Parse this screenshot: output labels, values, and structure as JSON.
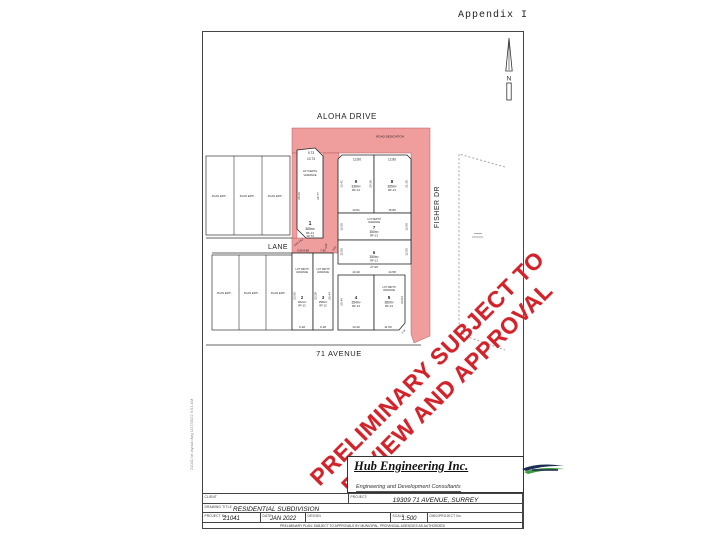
{
  "page": {
    "appendix_label": "Appendix I",
    "plot_stamp": "21041 lot layout.dwg   1/27/2022 9:51 AM"
  },
  "drawing": {
    "north_label": "N",
    "site_fill": "#ef9d9d",
    "streets": {
      "aloha": "ALOHA DRIVE",
      "lane": "LANE",
      "avenue71": "71 AVENUE",
      "fisher": "FISHER DR"
    },
    "road_dedication_note": "ROAD DEDICATION",
    "existing_lot_note": "PLAN EPP…",
    "misc_dims": {
      "d1": "5.32",
      "d2": "3.50"
    },
    "lots": {
      "lot1": {
        "number": "1",
        "area": "365m²",
        "zone": "RF-13",
        "note1": "LOT DEPTH",
        "note2": "VARIANCE",
        "dim_top1": "9.73",
        "dim_top2": "10.73",
        "dim_bottom": "10.73",
        "dim_left": "20.26",
        "dim_right": "26.77",
        "dim_corner": "0.62 4.62"
      },
      "lot2": {
        "number": "2",
        "area": "302m²",
        "zone": "RF-13",
        "note1": "LOT WIDTH",
        "note2": "VARIANCE",
        "dim_top": "0.50 8.68",
        "dim_left": "23.60",
        "dim_bottom": "9.18"
      },
      "lot3": {
        "number": "3",
        "area": "298m²",
        "zone": "RF-13",
        "note1": "LOT WIDTH",
        "note2": "VARIANCE",
        "dim_top": "7.56",
        "dim_left": "23.28",
        "dim_right": "26.44",
        "dim_bottom": "9.18"
      },
      "lot4": {
        "number": "4",
        "area": "354m²",
        "zone": "RF-13",
        "dim_top": "13.40",
        "dim_left": "26.44",
        "dim_bottom": "13.40"
      },
      "lot5": {
        "number": "5",
        "area": "380m²",
        "zone": "RF-13",
        "note1": "LOT WIDTH",
        "note2": "VARIANCE",
        "dim_top": "14.58",
        "dim_right": "23.04",
        "dim_bottom": "11.59",
        "dim_corner": "6.04"
      },
      "lot6": {
        "number": "6",
        "area": "350m²",
        "zone": "RF-13",
        "dim_left": "12.00",
        "dim_right": "12.05",
        "dim_bottom": "27.99"
      },
      "lot7": {
        "number": "7",
        "area": "350m²",
        "zone": "RF-13",
        "note1": "LOT DEPTH",
        "note2": "VARIANCE",
        "dim_left": "12.00",
        "dim_right": "12.00",
        "dim_bottom": "29.81"
      },
      "lot8": {
        "number": "8",
        "area": "365m²",
        "zone": "RF-13",
        "dim_top": "12.80",
        "dim_right": "21.35",
        "dim_bottom": "15.80"
      },
      "lot9": {
        "number": "9",
        "area": "336m²",
        "zone": "RF-13",
        "dim_top": "12.80",
        "dim_left": "13.41",
        "dim_right": "24.38",
        "dim_bottom": "13.81"
      }
    }
  },
  "stamp": {
    "line1": "PRELIMINARY SUBJECT TO",
    "line2": "REVIEW AND APPROVAL",
    "color": "#d2232a"
  },
  "titleblock": {
    "company_name": "Hub Engineering Inc.",
    "company_tagline": "Engineering and Development Consultants",
    "company_address": "Suite 312, 13955 - 76 Avenue, Surrey, B.C. V3W 2V6",
    "company_contact": "tel: 604-572-6528  |  fax: 604-501-1625  |  mail@hubeng.com  |  www.hubeng.com",
    "labels": {
      "client": "CLIENT",
      "project": "PROJECT:",
      "drawing_title": "DRAWING TITLE",
      "project_no": "PROJECT No.",
      "date": "DATE",
      "design": "DESIGN",
      "scale": "SCALE",
      "drawing_no": "DWG/PROJECT No."
    },
    "values": {
      "project": "19309 71 AVENUE, SURREY",
      "drawing_title": "RESIDENTIAL SUBDIVISION",
      "project_no": "21041",
      "date": "JAN 2022",
      "scale": "1:500"
    },
    "disclaimer": "PRELIMINARY PLAN: SUBJECT TO APPROVALS BY MUNICIPAL, PROVINCIAL AGENCIES AS AUTHORIZED"
  }
}
